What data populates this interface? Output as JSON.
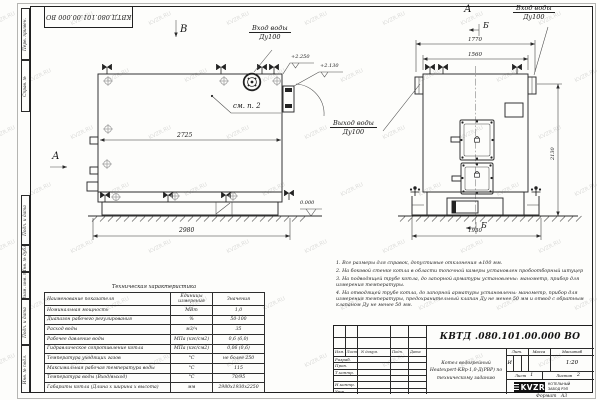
{
  "page": {
    "watermark": "KVZR.RU",
    "corner_stamp": "КВТД.080.101.00.000 ВО"
  },
  "margin_labels": [
    "Перв. примен.",
    "Справ. №",
    "Подп. и дата",
    "Инв. № дубл.",
    "Взам. инв. №",
    "Подп. и дата",
    "Инв. № подл."
  ],
  "side_view": {
    "view_arrow_label": "В",
    "direction_label": "А",
    "inlet_title": "Вход воды",
    "inlet_size": "Ду100",
    "note_ref": "см. п. 2",
    "elevation_top": "+2.250",
    "elevation_mid": "+2.130",
    "elevation_ground": "0.000",
    "dim_inner_length": "2725",
    "dim_overall_length": "2980"
  },
  "front_view": {
    "view_title": "А",
    "section_top": "Б",
    "section_bottom": "Б",
    "inlet_title": "Вход воды",
    "inlet_size": "Ду100",
    "outlet_title": "Выход воды",
    "outlet_size": "Ду100",
    "dim_flange_span": "1770",
    "dim_body_width": "1560",
    "dim_base_width": "1930",
    "dim_height": "2130"
  },
  "spec_table": {
    "title": "Техническая характеристика",
    "headers": [
      "Наименование показателя",
      "Единицы измерения",
      "Значения"
    ],
    "rows": [
      {
        "name": "Номинальная мощность",
        "unit": "МВт",
        "value": "1,0"
      },
      {
        "name": "Диапазон рабочего регулирования",
        "unit": "%",
        "value": "50-100"
      },
      {
        "name": "Расход воды",
        "unit": "м3/ч",
        "value": "35"
      },
      {
        "name": "Рабочее давление воды",
        "unit": "МПа (кгс/см2)",
        "value": "0,6 (6,0)"
      },
      {
        "name": "Гидравлическое сопротивление котла",
        "unit": "МПа (кгс/см2)",
        "value": "0,06 (0,6)"
      },
      {
        "name": "Температура уходящих газов",
        "unit": "°С",
        "value": "не более 250"
      },
      {
        "name": "Максимальная рабочая температура воды",
        "unit": "°С",
        "value": "115"
      },
      {
        "name": "Температура воды (Вход/выход)",
        "unit": "°С",
        "value": "70/95"
      },
      {
        "name": "Габариты котла (Длина х ширина х высота)",
        "unit": "мм",
        "value": "2980х1930х2250"
      }
    ]
  },
  "notes": [
    "1. Все размеры для справок, допустимые отклонения ±100 мм.",
    "2. На боковой стенке котла в области топочной камеры установлен пробоотборный штуцер",
    "3. На подводящей трубе котла, до запорной арматуры установлены: манометр, прибор для измерения температуры.",
    "4. На отводящей трубе котла, до запорной арматуры установлены: манометр, прибор для измерения температуры, предохранительный клапан Ду не менее 50 мм и отвод с обратным клапаном Ду не менее 50 мм."
  ],
  "title_block": {
    "doc_number": "КВТД .080.101.00.000  ВО",
    "col_headers": [
      "Изм.",
      "Лист",
      "N докум.",
      "Подп.",
      "Дата"
    ],
    "row_labels": [
      "Разраб.",
      "Пров.",
      "Т.контр.",
      "Н.контр.",
      "Утв."
    ],
    "product_lines": [
      "Котел водогрейный",
      "Heatexpert-КВр-1,0-Д(РВР) по",
      "техническому заданию"
    ],
    "lit_header": "Лит.",
    "mass_header": "Масса",
    "scale_header": "Масштаб",
    "lit_value": "И",
    "scale_value": "1:20",
    "sheet_label": "Лист",
    "sheet_value": "1",
    "sheets_label": "Листов",
    "sheets_value": "2",
    "logo": "KVZR",
    "company": [
      "КОТЕЛЬНЫЙ",
      "ЗАВОД РЭП"
    ],
    "format_label": "Формат",
    "format_value": "А3"
  }
}
